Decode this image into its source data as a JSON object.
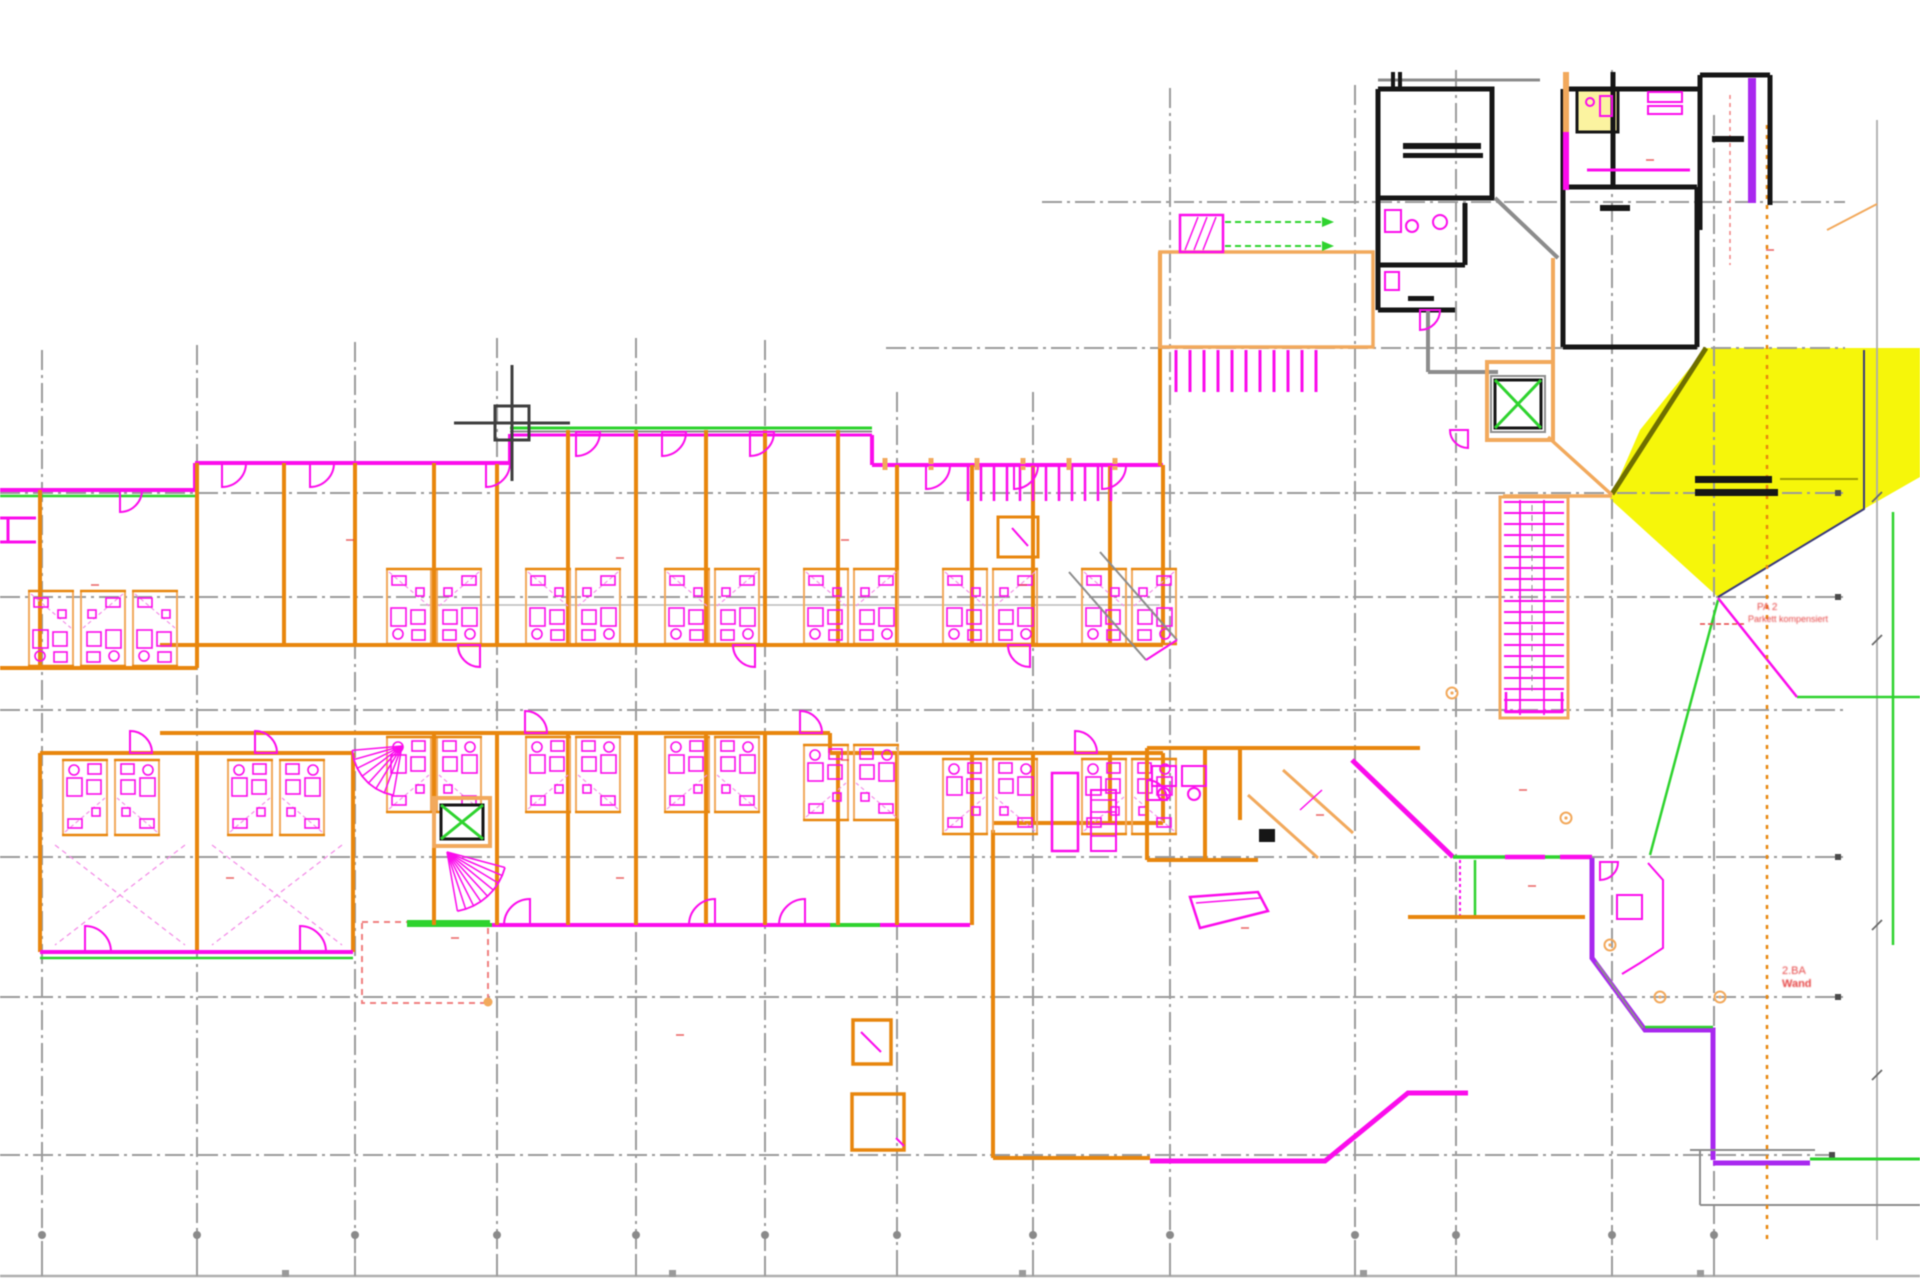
{
  "document": {
    "type": "cad-floor-plan-screenshot",
    "content": "architectural floor plan with CAD crosshair cursor and yellow highlighted zone"
  },
  "colors": {
    "background": "#FFFFFF",
    "grid": "#9B9B9B",
    "frame": "#ADADAD",
    "wall_orange": "#E8860D",
    "wall_tan": "#F2A95C",
    "magenta": "#FB0CEC",
    "purple": "#A928EF",
    "green": "#2ED32E",
    "yellow": "#F6F600",
    "pale_yellow": "#FBF3A0",
    "black": "#161616",
    "gray_wall": "#8C8C8C",
    "olive": "#6F6F00",
    "navy": "#3A3A7A",
    "red": "#E64545",
    "red_dash": "#F08080",
    "cursor": "#3F3F3F",
    "pink_dash": "#F490E8"
  },
  "annotations": {
    "note_a": {
      "line1": "PA 2",
      "line2": "Parkett kompensiert"
    },
    "note_b": {
      "line1": "2.BA",
      "line2": "Wand"
    }
  },
  "cursor": {
    "x": 512,
    "y": 423,
    "pickbox": 34,
    "arm": 58
  },
  "highlight": {
    "name": "yellow-marked-area",
    "color": "#F6F600"
  },
  "plan": {
    "grid": {
      "verticals": [
        [
          42,
          350,
          1276
        ],
        [
          197,
          345,
          1276
        ],
        [
          355,
          342,
          1276
        ],
        [
          497,
          338,
          1276
        ],
        [
          636,
          338,
          1276
        ],
        [
          765,
          340,
          1276
        ],
        [
          897,
          392,
          1276
        ],
        [
          1033,
          392,
          1276
        ],
        [
          1170,
          88,
          1276
        ],
        [
          1355,
          85,
          1276
        ],
        [
          1456,
          70,
          1276
        ],
        [
          1612,
          70,
          1276
        ],
        [
          1714,
          115,
          1276
        ]
      ],
      "horizontals": [
        [
          202,
          1042,
          1845
        ],
        [
          348,
          886,
          1845
        ],
        [
          493,
          0,
          1845
        ],
        [
          597,
          0,
          1845
        ],
        [
          710,
          0,
          1845
        ],
        [
          857,
          0,
          1845
        ],
        [
          997,
          0,
          1845
        ],
        [
          1155,
          0,
          1832
        ]
      ],
      "end_dots": [
        [
          1838,
          493
        ],
        [
          1838,
          597
        ],
        [
          1838,
          857
        ],
        [
          1838,
          997
        ],
        [
          1832,
          1155
        ]
      ],
      "bottom": {
        "line_y": 1276,
        "tick_y1": 1256,
        "dot_y": 1235,
        "square_y": 1270,
        "square_xs": [
          285,
          672,
          1022,
          1363,
          1700
        ]
      },
      "dimline": {
        "x": 1877,
        "y1": 120,
        "y2": 1240,
        "ticks": [
          497,
          640,
          925,
          1075
        ]
      }
    },
    "wing": {
      "partitions_upper": [
        [
          197,
          463,
          645
        ],
        [
          284,
          463,
          645
        ],
        [
          355,
          463,
          645
        ],
        [
          434,
          463,
          645
        ],
        [
          497,
          463,
          645
        ],
        [
          568,
          430,
          645
        ],
        [
          636,
          430,
          645
        ],
        [
          706,
          430,
          645
        ],
        [
          765,
          430,
          645
        ],
        [
          838,
          430,
          645
        ],
        [
          897,
          465,
          645
        ],
        [
          972,
          465,
          645
        ],
        [
          1033,
          465,
          645
        ],
        [
          1110,
          465,
          645
        ],
        [
          1163,
          465,
          645
        ]
      ],
      "partitions_lower": [
        [
          434,
          733,
          925
        ],
        [
          497,
          733,
          925
        ],
        [
          568,
          733,
          925
        ],
        [
          636,
          733,
          925
        ],
        [
          706,
          733,
          925
        ],
        [
          765,
          733,
          925
        ],
        [
          838,
          753,
          925
        ],
        [
          897,
          753,
          925
        ],
        [
          972,
          753,
          925
        ],
        [
          1033,
          753,
          823
        ],
        [
          1110,
          753,
          823
        ],
        [
          1163,
          753,
          823
        ]
      ]
    },
    "pods": [
      [
        386,
        566,
        0,
        0
      ],
      [
        436,
        566,
        1,
        0
      ],
      [
        525,
        566,
        0,
        0
      ],
      [
        575,
        566,
        1,
        0
      ],
      [
        664,
        566,
        0,
        0
      ],
      [
        714,
        566,
        1,
        0
      ],
      [
        803,
        566,
        0,
        0
      ],
      [
        853,
        566,
        1,
        0
      ],
      [
        942,
        566,
        0,
        0
      ],
      [
        992,
        566,
        1,
        0
      ],
      [
        1081,
        566,
        0,
        0
      ],
      [
        1131,
        566,
        1,
        0
      ],
      [
        386,
        735,
        0,
        1
      ],
      [
        436,
        735,
        1,
        1
      ],
      [
        525,
        735,
        0,
        1
      ],
      [
        575,
        735,
        1,
        1
      ],
      [
        664,
        735,
        0,
        1
      ],
      [
        714,
        735,
        1,
        1
      ],
      [
        803,
        743,
        0,
        1
      ],
      [
        853,
        743,
        1,
        1
      ],
      [
        942,
        757,
        0,
        1
      ],
      [
        992,
        757,
        1,
        1
      ],
      [
        1081,
        757,
        0,
        1
      ],
      [
        1131,
        757,
        1,
        1
      ],
      [
        28,
        588,
        0,
        0
      ],
      [
        80,
        588,
        1,
        0
      ],
      [
        132,
        588,
        0,
        0
      ],
      [
        62,
        758,
        0,
        1
      ],
      [
        114,
        758,
        1,
        1
      ],
      [
        227,
        758,
        0,
        1
      ],
      [
        279,
        758,
        1,
        1
      ]
    ],
    "arcs": [
      [
        222,
        463,
        24,
        1,
        1
      ],
      [
        310,
        463,
        24,
        1,
        1
      ],
      [
        486,
        463,
        24,
        1,
        1
      ],
      [
        576,
        432,
        24,
        1,
        1
      ],
      [
        662,
        432,
        24,
        1,
        1
      ],
      [
        750,
        432,
        24,
        1,
        1
      ],
      [
        926,
        465,
        24,
        1,
        1
      ],
      [
        1014,
        465,
        24,
        1,
        1
      ],
      [
        1102,
        465,
        24,
        1,
        1
      ],
      [
        480,
        645,
        22,
        -1,
        1
      ],
      [
        755,
        645,
        22,
        -1,
        1
      ],
      [
        1030,
        645,
        22,
        -1,
        1
      ],
      [
        525,
        733,
        22,
        1,
        -1
      ],
      [
        800,
        733,
        22,
        1,
        -1
      ],
      [
        1075,
        753,
        22,
        1,
        -1
      ],
      [
        530,
        925,
        26,
        -1,
        -1
      ],
      [
        715,
        925,
        26,
        -1,
        -1
      ],
      [
        805,
        925,
        26,
        -1,
        -1
      ],
      [
        130,
        753,
        22,
        1,
        -1
      ],
      [
        255,
        753,
        22,
        1,
        -1
      ],
      [
        85,
        952,
        26,
        1,
        -1
      ],
      [
        300,
        952,
        26,
        1,
        -1
      ],
      [
        120,
        490,
        22,
        1,
        1
      ],
      [
        1420,
        310,
        20,
        1,
        1
      ],
      [
        1468,
        430,
        18,
        -1,
        1
      ],
      [
        1600,
        862,
        18,
        1,
        1
      ],
      [
        1147,
        800,
        20,
        1,
        -1
      ]
    ],
    "stair": {
      "x1": 1504,
      "x2": 1564,
      "y1": 502,
      "y2": 712,
      "step": 11
    },
    "fans": [
      {
        "cx": 447,
        "cy": 852,
        "r": 60,
        "a1": 15,
        "a2": 80,
        "n": 8
      },
      {
        "cx": 402,
        "cy": 746,
        "r": 50,
        "a1": 100,
        "a2": 175,
        "n": 7
      }
    ],
    "studs": [
      {
        "x1": 968,
        "x2": 1113,
        "y": 467,
        "h": 34,
        "step": 13,
        "w": 2.5,
        "c": "magenta"
      },
      {
        "x1": 1176,
        "x2": 1328,
        "y": 350,
        "h": 42,
        "step": 14,
        "w": 3,
        "c": "magenta"
      },
      {
        "x1": 885,
        "x2": 1158,
        "y": 458,
        "h": 12,
        "step": 46,
        "w": 5,
        "c": "wall_tan"
      }
    ],
    "black_bars": [
      [
        1403,
        143,
        78,
        6
      ],
      [
        1403,
        153,
        80,
        5
      ],
      [
        1712,
        136,
        32,
        6
      ],
      [
        1600,
        205,
        30,
        6
      ],
      [
        1695,
        476,
        77,
        7
      ],
      [
        1695,
        489,
        83,
        7
      ],
      [
        1408,
        296,
        26,
        5
      ]
    ],
    "red_ticks": [
      [
        350,
        540
      ],
      [
        620,
        558
      ],
      [
        845,
        540
      ],
      [
        95,
        585
      ],
      [
        1023,
        585
      ],
      [
        230,
        878
      ],
      [
        620,
        878
      ],
      [
        845,
        760
      ],
      [
        1320,
        815
      ],
      [
        1523,
        790
      ],
      [
        1532,
        886
      ],
      [
        455,
        938
      ],
      [
        680,
        1035
      ],
      [
        1245,
        928
      ],
      [
        1650,
        160
      ],
      [
        1770,
        250
      ]
    ],
    "markers": [
      [
        1660,
        997
      ],
      [
        1720,
        997
      ],
      [
        1610,
        945
      ],
      [
        1452,
        693
      ],
      [
        1566,
        818
      ]
    ]
  }
}
